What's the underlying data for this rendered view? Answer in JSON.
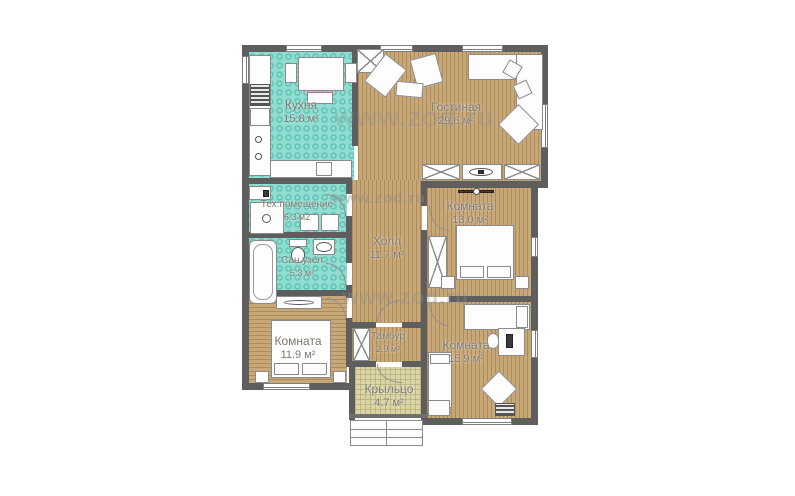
{
  "watermark": {
    "text": "www.zod.ru"
  },
  "rooms": {
    "kitchen": {
      "name": "Кухня",
      "area": "15.8 м²"
    },
    "living": {
      "name": "Гостиная",
      "area": "29.8 м²"
    },
    "tech": {
      "name": "Тех.помещение",
      "area": "6.3 м2"
    },
    "bath": {
      "name": "Сан.узел",
      "area": "6.3 м²"
    },
    "hall": {
      "name": "Холл",
      "area": "11.7 м²"
    },
    "bedroom1": {
      "name": "Комната",
      "area": "13.0 м²"
    },
    "bedroom2": {
      "name": "Комната",
      "area": "11.9 м²"
    },
    "bedroom3": {
      "name": "Комната",
      "area": "15.9 м²"
    },
    "tambour": {
      "name": "Тамбур",
      "area": "2.9 м²"
    },
    "porch": {
      "name": "Крыльцо",
      "area": "4.7 м²"
    }
  },
  "colors": {
    "wall": "#5e5e5e",
    "wood_floor": "#c9a878",
    "tile_floor": "#90ddd2",
    "porch_floor": "#dbd5a6",
    "label_text": "#7c7871",
    "watermark": "#8c8c8c"
  }
}
